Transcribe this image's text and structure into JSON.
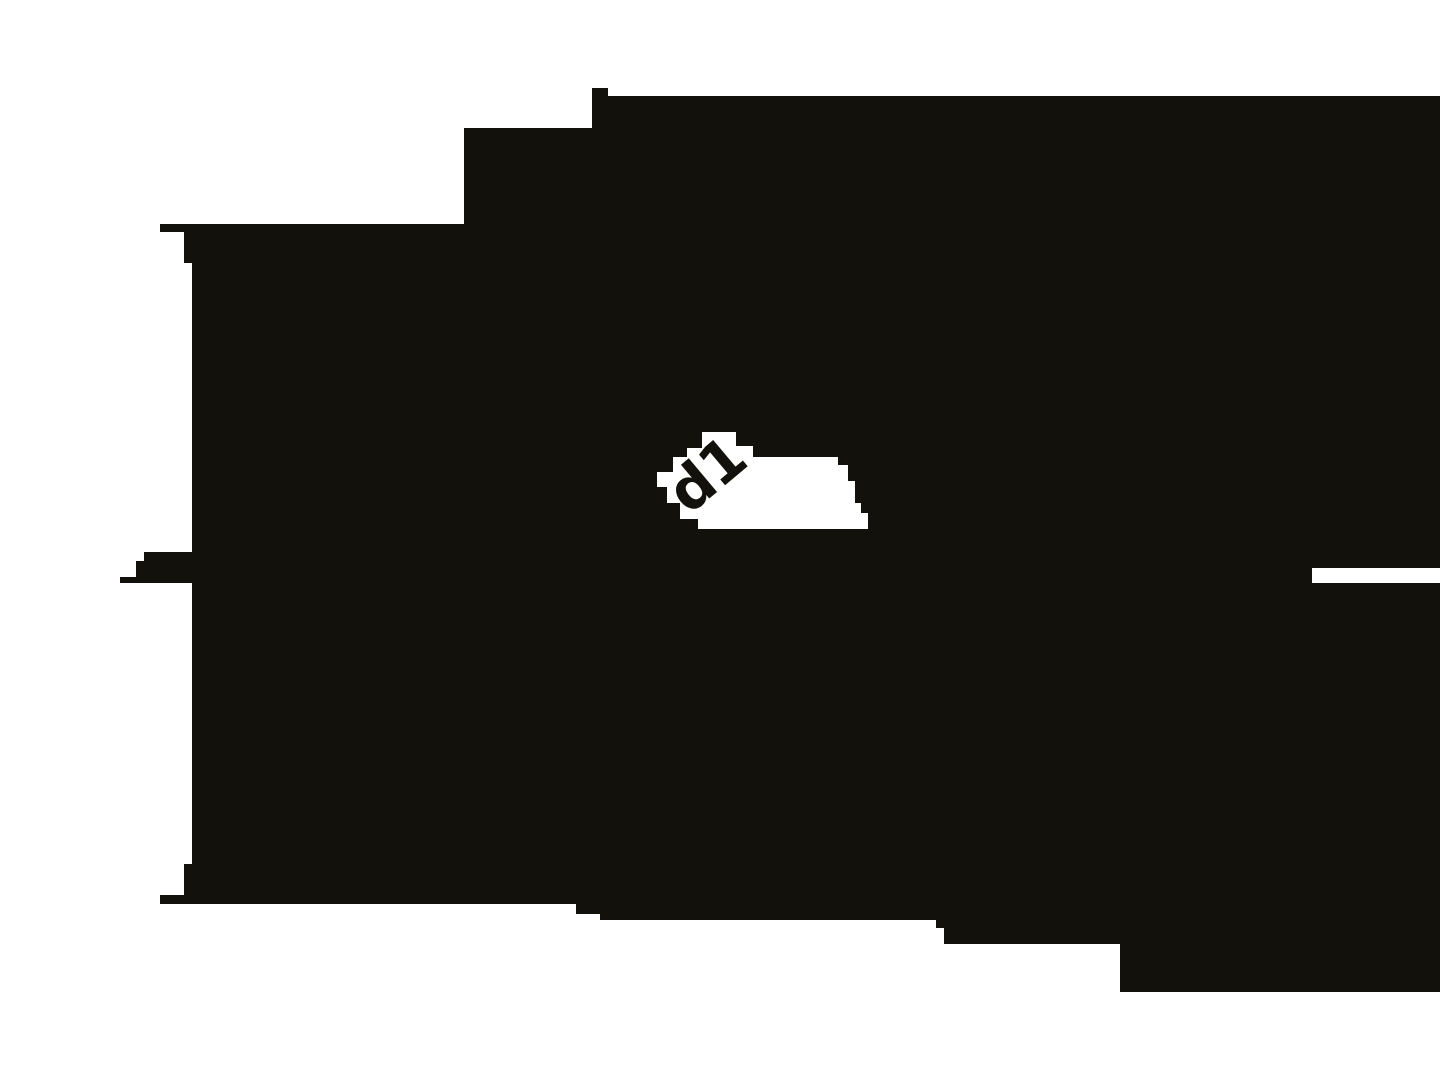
{
  "image": {
    "width": 1440,
    "height": 1080,
    "alt": "Extreme magnification of a monochrome technical drawing: a pixelated dark filled section with a white window holding the dimension label d1 and a horizontal dimension-line gap at the right edge"
  },
  "colors": {
    "background": "#ffffff",
    "ink": "#13110b",
    "label_window": "#ffffff",
    "label_text": "#13110b",
    "dimension_gap": "#ffffff"
  },
  "label": {
    "text": "d1",
    "center_x": 706,
    "center_y": 474,
    "rotation_deg": -40,
    "font_size_px": 58
  },
  "geometry": {
    "silhouette_path": "M592,88 L608,88 L608,96 L1440,96 L1440,992 L1120,992 L1120,944 L944,944 L944,928 L936,928 L936,920 L600,920 L600,914 L576,914 L576,904 L160,904 L160,895 L184,895 L184,864 L192,864 L192,583 L120,583 L120,577 L136,577 L136,561 L144,561 L144,552 L192,552 L192,263 L184,263 L184,232 L160,232 L160,224 L464,224 L464,128 L592,128 Z",
    "label_window_path": "M702,432 L736,432 L736,446 L753,446 L753,457 L838,457 L838,465 L848,465 L848,481 L855,481 L855,503 L861,503 L861,513 L868,513 L868,529 L698,529 L698,519 L680,519 L680,503 L667,503 L667,487 L657,487 L657,472 L673,472 L673,457 L687,457 L687,448 L702,448 Z",
    "dimension_gap_rect": {
      "x": 1312,
      "y": 568,
      "width": 128,
      "height": 15
    }
  }
}
